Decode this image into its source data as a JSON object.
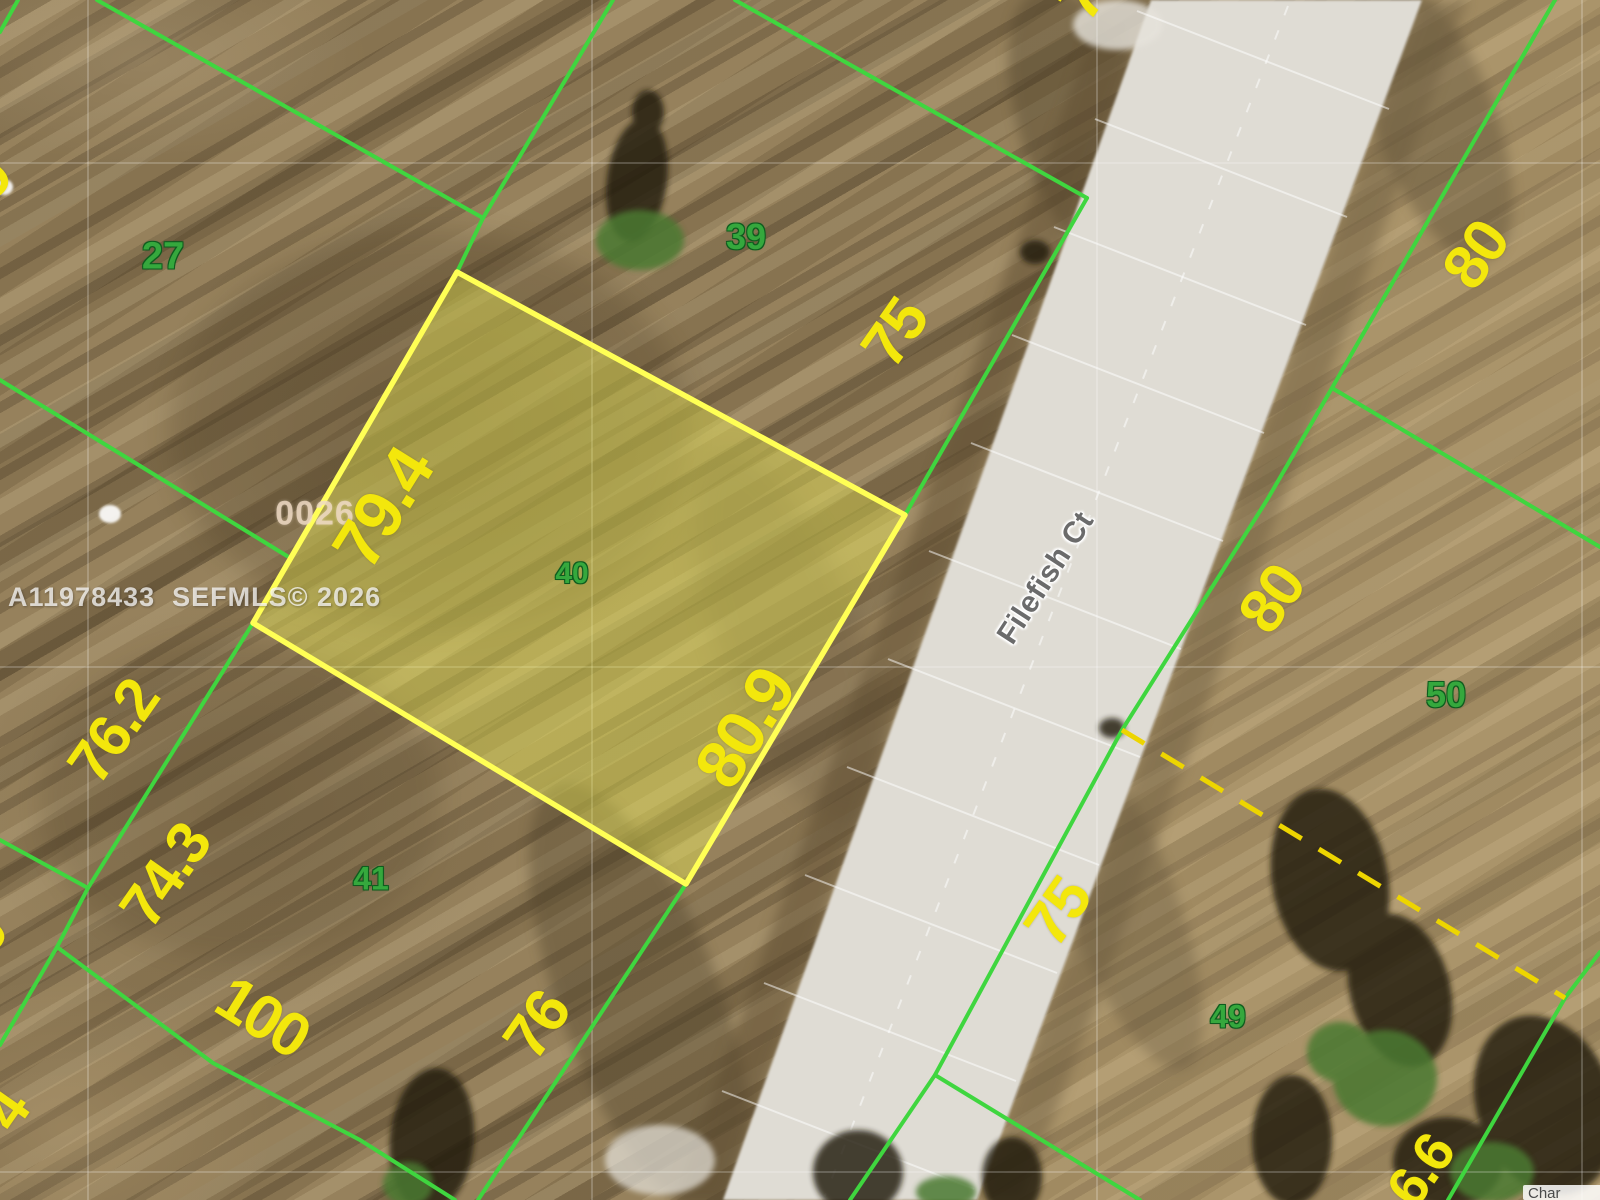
{
  "watermark": {
    "text": "A11978433  SEFMLS© 2026"
  },
  "block_code": "0026",
  "road": {
    "name": "Filefish Ct"
  },
  "attribution": {
    "text": "Char"
  },
  "lots": [
    {
      "number": "27",
      "highlighted": false
    },
    {
      "number": "39",
      "highlighted": false
    },
    {
      "number": "40",
      "highlighted": true
    },
    {
      "number": "41",
      "highlighted": false
    },
    {
      "number": "50",
      "highlighted": false
    },
    {
      "number": "49",
      "highlighted": false
    }
  ],
  "dimensions": [
    {
      "label": "79.4",
      "lot": "40",
      "edge": "rear"
    },
    {
      "label": "80.9",
      "lot": "40",
      "edge": "road-front"
    },
    {
      "label": "75",
      "lot": "39",
      "edge": "road-front"
    },
    {
      "label": "76",
      "lot": "41",
      "edge": "road-front"
    },
    {
      "label": "100",
      "lot": "41",
      "edge": "south"
    },
    {
      "label": "76.2",
      "lot": "left-block",
      "edge": "side"
    },
    {
      "label": "74.3",
      "lot": "left-block",
      "edge": "side"
    },
    {
      "label": "80",
      "lot": "north-of-50",
      "edge": "road-front"
    },
    {
      "label": "80",
      "lot": "50",
      "edge": "road-front"
    },
    {
      "label": "75",
      "lot": "49",
      "edge": "road-front"
    },
    {
      "label": "75",
      "lot": "north-of-39",
      "edge": "road-front",
      "partial": true
    },
    {
      "label": "6.6",
      "lot": "bottom-right",
      "edge": "partial",
      "partial": true
    },
    {
      "label": "9",
      "lot": "left-edge-top",
      "edge": "partial",
      "partial": true
    },
    {
      "label": "0",
      "lot": "left-edge-mid",
      "edge": "partial",
      "partial": true
    },
    {
      "label": "4",
      "lot": "left-edge-bottom",
      "edge": "partial",
      "partial": true
    }
  ],
  "colors": {
    "boundary_green": "#3fd63f",
    "lot_number_green": "#35a83d",
    "dimension_yellow": "#f3e70c",
    "dashed_yellow": "#edd500",
    "highlight_fill": "rgba(232,232,80,0.42)",
    "highlight_border": "#ffff55",
    "road_gray": "#dfdcd4"
  }
}
